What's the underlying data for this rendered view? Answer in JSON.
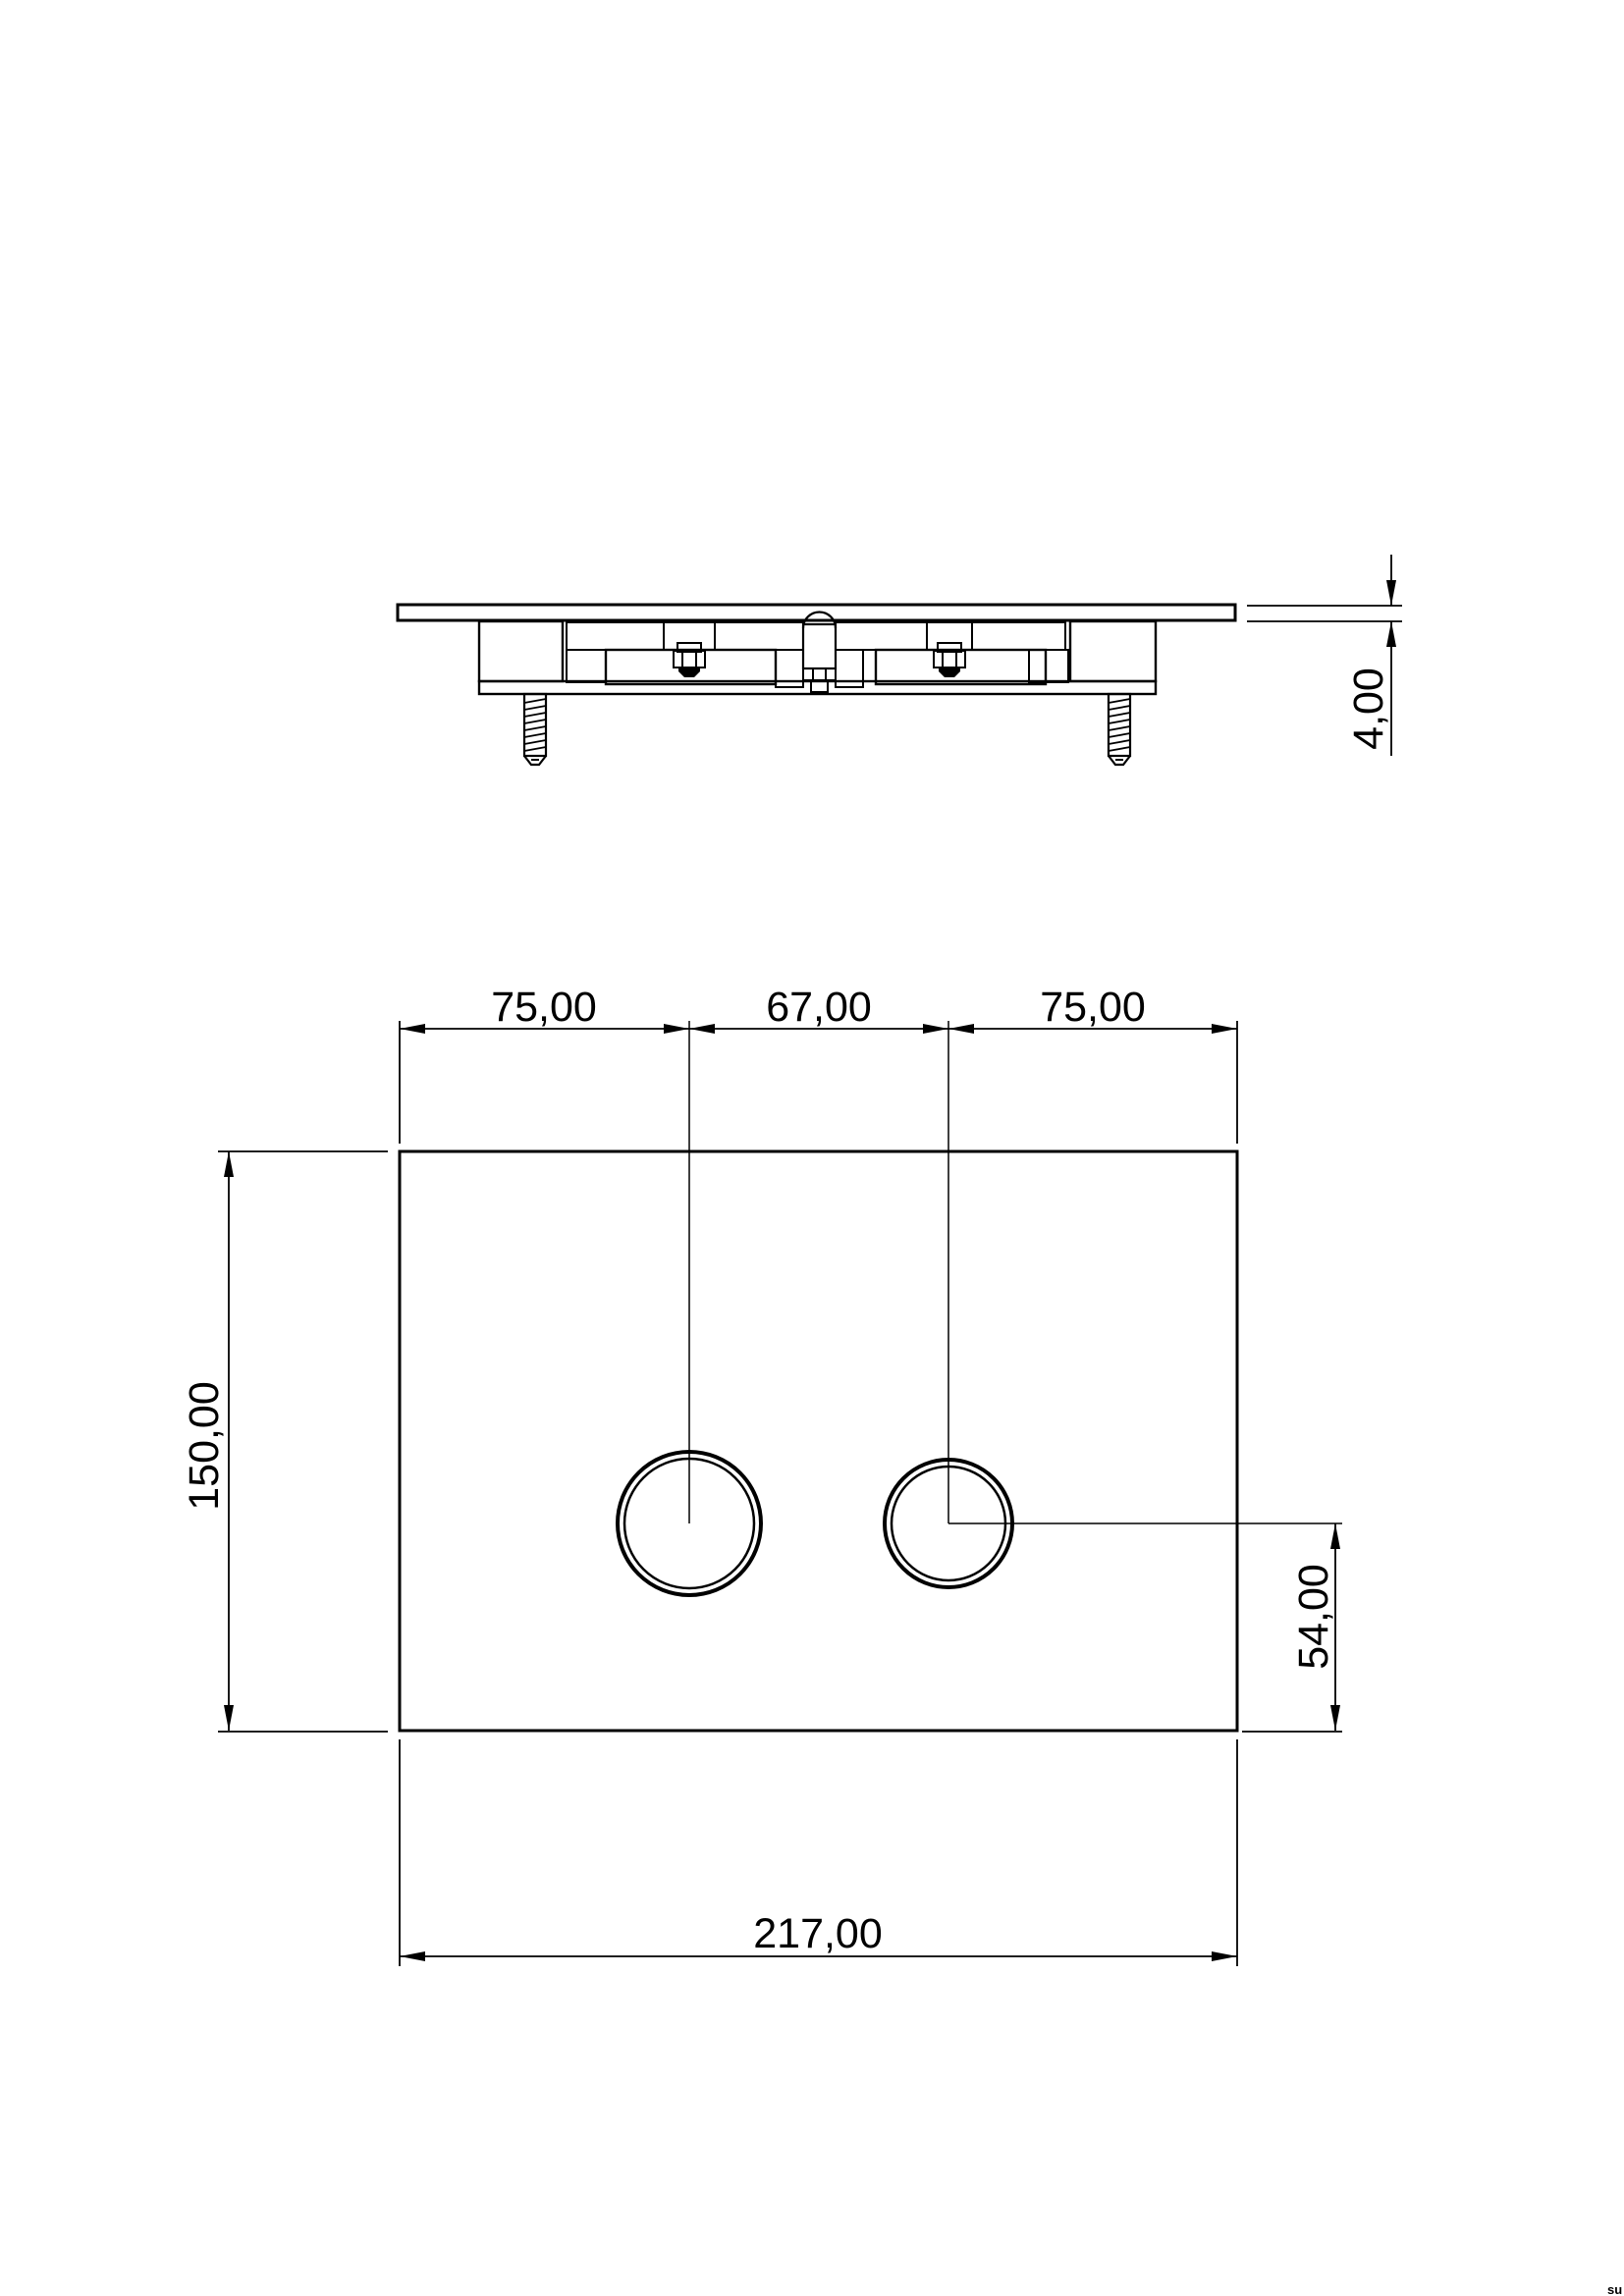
{
  "colors": {
    "ink": "#000000",
    "background": "#ffffff"
  },
  "side_view": {
    "thickness_dim": "4,00"
  },
  "front_view": {
    "top_dimensions": [
      "75,00",
      "67,00",
      "75,00"
    ],
    "height_dim": "150,00",
    "button_offset_dim": "54,00",
    "width_dim": "217,00"
  },
  "watermark": "su"
}
